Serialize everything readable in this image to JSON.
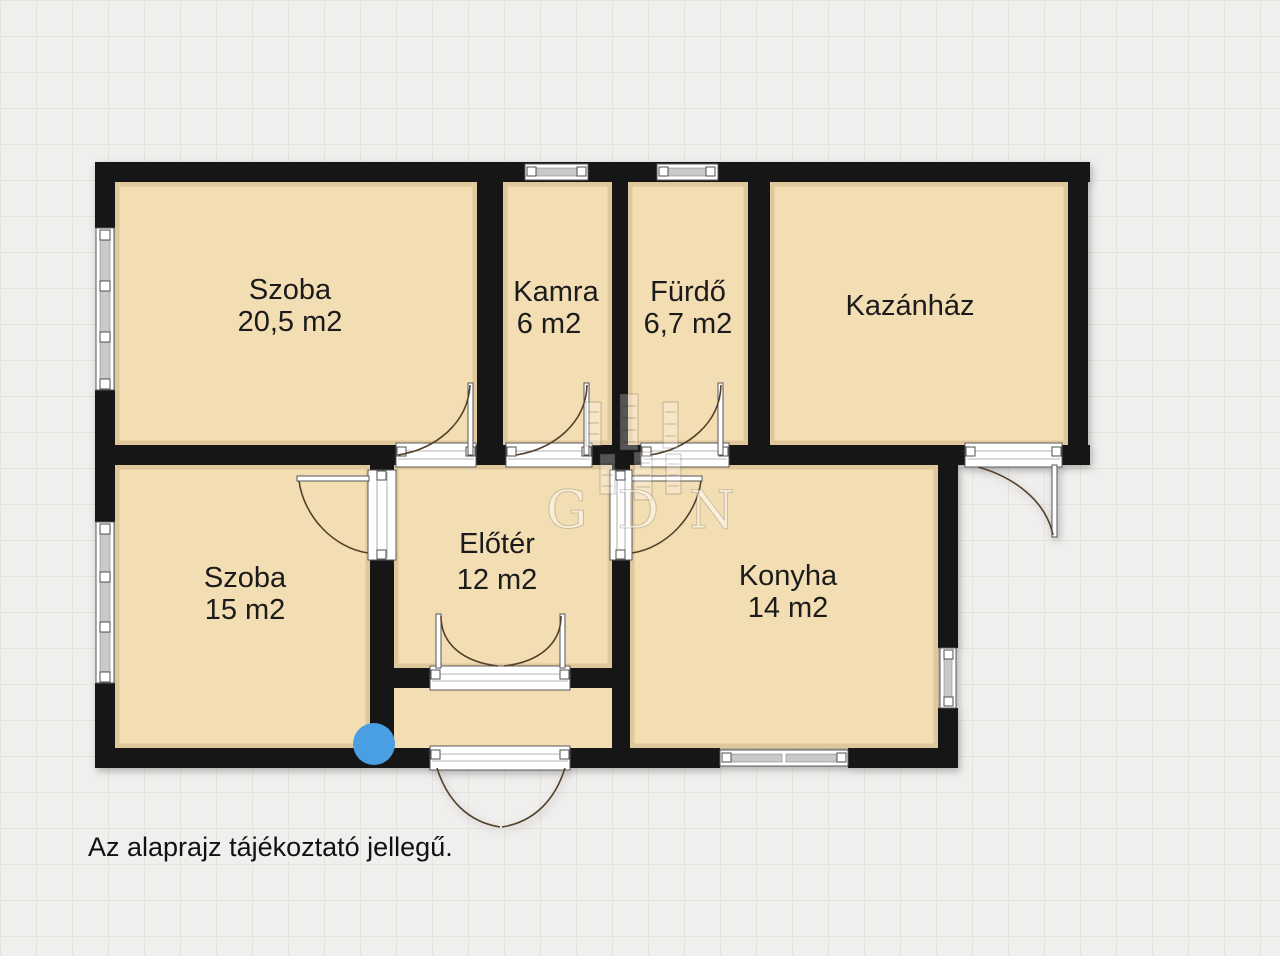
{
  "caption": "Az alaprajz tájékoztató jellegű.",
  "watermark": {
    "text": "GDN"
  },
  "rooms": {
    "szoba1": {
      "name": "Szoba",
      "area": "20,5 m2"
    },
    "kamra": {
      "name": "Kamra",
      "area": "6 m2"
    },
    "furdo": {
      "name": "Fürdő",
      "area": "6,7 m2"
    },
    "kazanhaz": {
      "name": "Kazánház",
      "area": ""
    },
    "szoba2": {
      "name": "Szoba",
      "area": "15 m2"
    },
    "eloter": {
      "name": "Előtér",
      "area": "12 m2"
    },
    "konyha": {
      "name": "Konyha",
      "area": "14 m2"
    }
  },
  "colors": {
    "room_fill": "#f3ddb2",
    "wall": "#161616",
    "background": "#f0efed",
    "grid_line": "#e4e3df",
    "window_gray": "#c9c9c9",
    "marker_blue": "#4a9ee2"
  }
}
